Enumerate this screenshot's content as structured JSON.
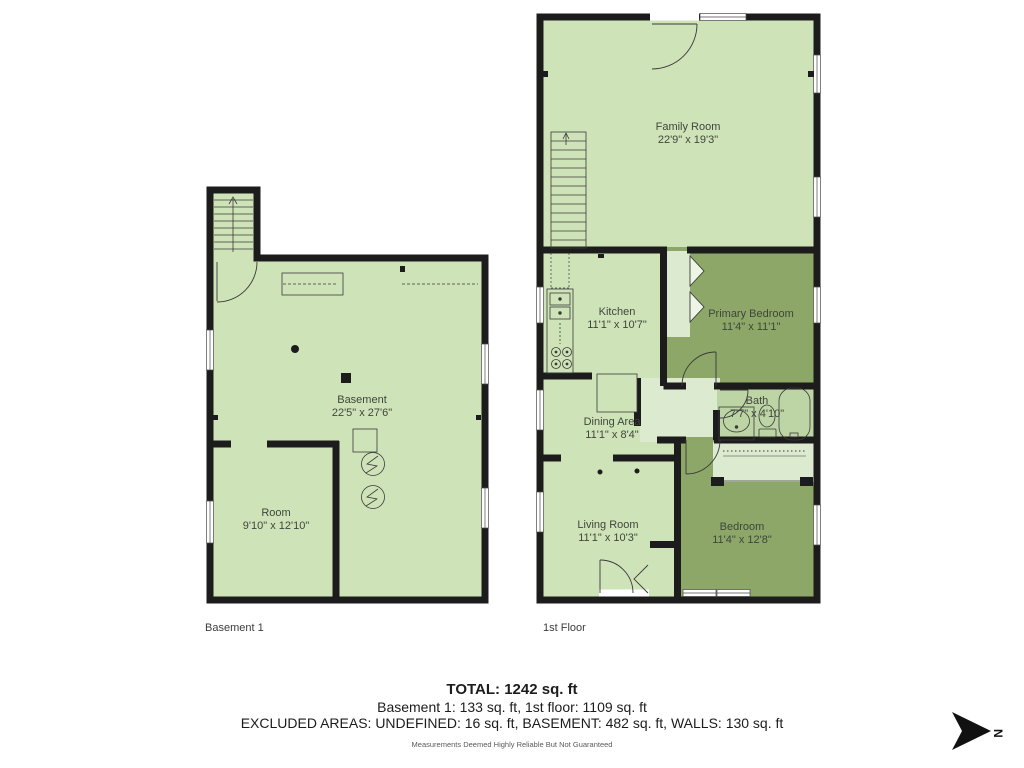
{
  "basement": {
    "floor_label": "Basement 1",
    "rooms": {
      "basement": {
        "name": "Basement",
        "dims": "22'5\" x 27'6\""
      },
      "room": {
        "name": "Room",
        "dims": "9'10\" x 12'10\""
      }
    }
  },
  "first_floor": {
    "floor_label": "1st Floor",
    "rooms": {
      "family_room": {
        "name": "Family Room",
        "dims": "22'9\" x 19'3\""
      },
      "kitchen": {
        "name": "Kitchen",
        "dims": "11'1\" x 10'7\""
      },
      "primary_bedroom": {
        "name": "Primary Bedroom",
        "dims": "11'4\" x 11'1\""
      },
      "dining_area": {
        "name": "Dining Area",
        "dims": "11'1\" x 8'4\""
      },
      "bath": {
        "name": "Bath",
        "dims": "7'7\" x 4'10\""
      },
      "living_room": {
        "name": "Living Room",
        "dims": "11'1\" x 10'3\""
      },
      "bedroom": {
        "name": "Bedroom",
        "dims": "11'4\" x 12'8\""
      }
    }
  },
  "summary": {
    "total": "TOTAL: 1242 sq. ft",
    "floor_breakdown": "Basement 1: 133 sq. ft, 1st floor: 1109 sq. ft",
    "excluded_areas": "EXCLUDED AREAS: UNDEFINED: 16 sq. ft, BASEMENT: 482 sq. ft, WALLS: 130 sq. ft",
    "disclaimer": "Measurements Deemed Highly Reliable But Not Guaranteed"
  },
  "compass": {
    "label": "N"
  },
  "colors": {
    "room_light": "#cfe3b8",
    "room_dark": "#8ca767",
    "bath_green": "#bdd4a4",
    "hall_light": "#dcead0",
    "wall": "#1c1c1c"
  }
}
